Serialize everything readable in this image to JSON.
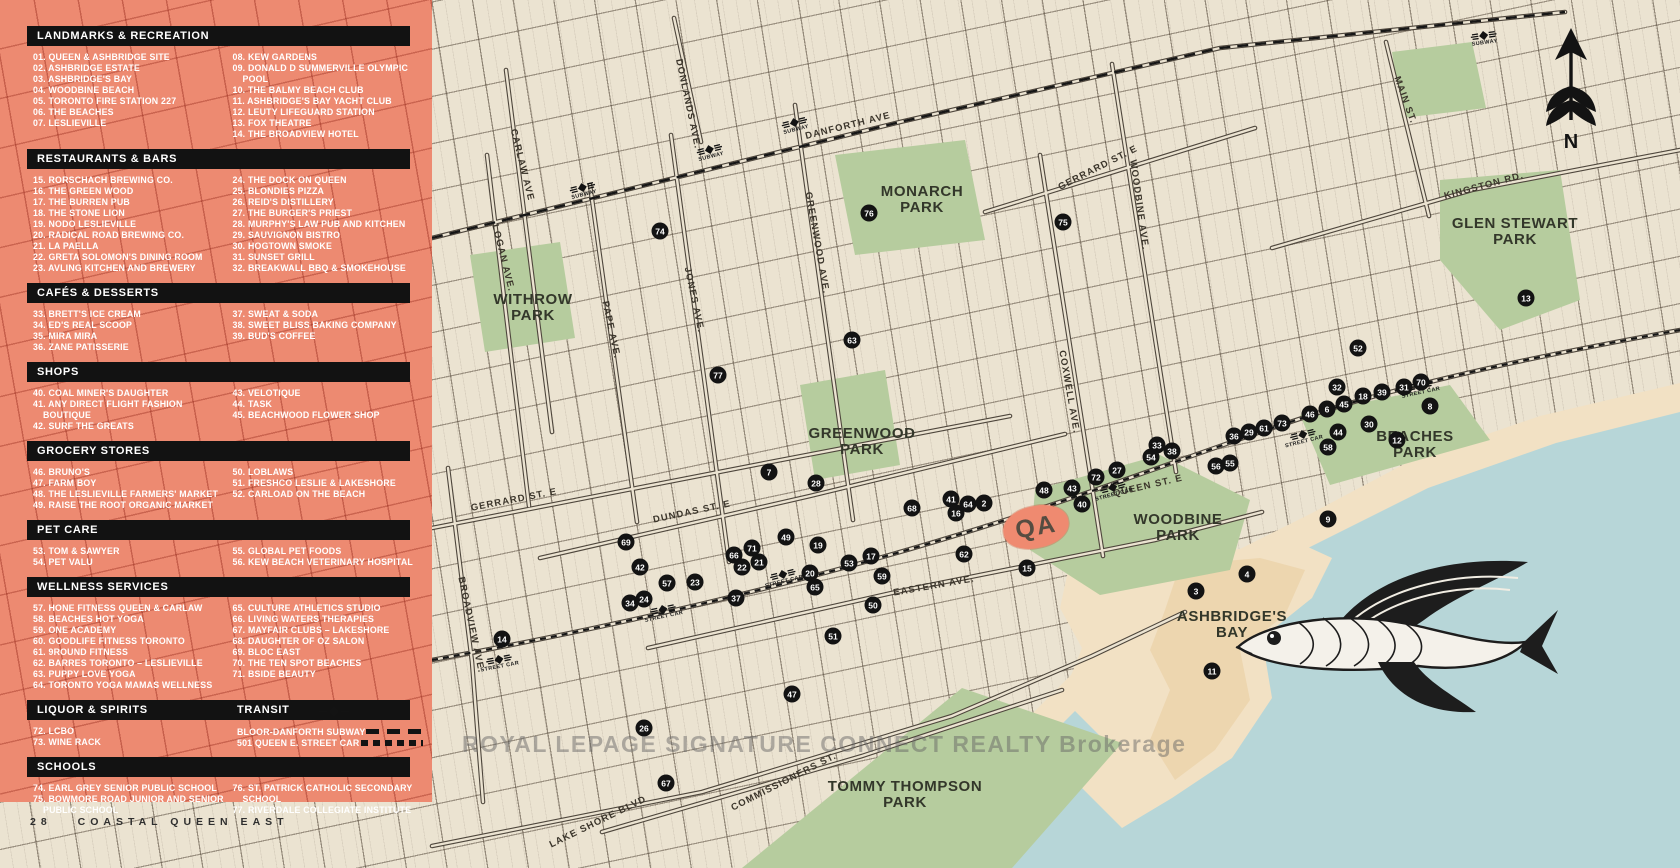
{
  "page": {
    "footer_page_number": "28",
    "footer_title": "COASTAL QUEEN EAST",
    "watermark": "ROYAL LEPAGE SIGNATURE CONNECT REALTY Brokerage"
  },
  "colors": {
    "salmon": "#ed8a71",
    "bar_black": "#121212",
    "map_cream": "#ebe3d1",
    "park_green": "#b6cc9e",
    "water_blue": "#b7d6d8",
    "sand": "#f2e1c4"
  },
  "compass": {
    "north_label": "N"
  },
  "site_logo": {
    "text": "QA"
  },
  "legend": {
    "sections": [
      {
        "title": "LANDMARKS & RECREATION",
        "columns": [
          [
            "01. QUEEN & ASHBRIDGE SITE",
            "02. ASHBRIDGE ESTATE",
            "03. ASHBRIDGE'S BAY",
            "04. WOODBINE BEACH",
            "05. TORONTO FIRE STATION 227",
            "06. THE BEACHES",
            "07. LESLIEVILLE"
          ],
          [
            "08. KEW GARDENS",
            "09. DONALD D SUMMERVILLE OLYMPIC POOL",
            "10. THE BALMY BEACH CLUB",
            "11. ASHBRIDGE'S BAY YACHT CLUB",
            "12. LEUTY LIFEGUARD STATION",
            "13. FOX THEATRE",
            "14. THE BROADVIEW HOTEL"
          ]
        ]
      },
      {
        "title": "RESTAURANTS & BARS",
        "columns": [
          [
            "15. RORSCHACH BREWING CO.",
            "16. THE GREEN WOOD",
            "17. THE BURREN PUB",
            "18. THE STONE LION",
            "19. NODO LESLIEVILLE",
            "20. RADICAL ROAD BREWING CO.",
            "21. LA PAELLA",
            "22. GRETA SOLOMON'S DINING ROOM",
            "23. AVLING KITCHEN AND BREWERY"
          ],
          [
            "24. THE DOCK ON QUEEN",
            "25. BLONDIES PIZZA",
            "26. REID'S DISTILLERY",
            "27. THE BURGER'S PRIEST",
            "28. MURPHY'S LAW PUB AND KITCHEN",
            "29. SAUVIGNON BISTRO",
            "30. HOGTOWN SMOKE",
            "31. SUNSET GRILL",
            "32. BREAKWALL BBQ & SMOKEHOUSE"
          ]
        ]
      },
      {
        "title": "CAFÉS & DESSERTS",
        "columns": [
          [
            "33. BRETT'S ICE CREAM",
            "34. ED'S REAL SCOOP",
            "35. MIRA MIRA",
            "36. ZANE PATISSERIE"
          ],
          [
            "37. SWEAT & SODA",
            "38. SWEET BLISS BAKING COMPANY",
            "39. BUD'S COFFEE"
          ]
        ]
      },
      {
        "title": "SHOPS",
        "columns": [
          [
            "40. COAL MINER'S DAUGHTER",
            "41. ANY DIRECT FLIGHT FASHION BOUTIQUE",
            "42. SURF THE GREATS"
          ],
          [
            "43. VELOTIQUE",
            "44. TASK",
            "45. BEACHWOOD FLOWER SHOP"
          ]
        ]
      },
      {
        "title": "GROCERY STORES",
        "columns": [
          [
            "46. BRUNO'S",
            "47. FARM BOY",
            "48. THE LESLIEVILLE FARMERS' MARKET",
            "49. RAISE THE ROOT ORGANIC MARKET"
          ],
          [
            "50. LOBLAWS",
            "51. FRESHCO LESLIE & LAKESHORE",
            "52. CARLOAD ON THE BEACH"
          ]
        ]
      },
      {
        "title": "PET CARE",
        "columns": [
          [
            "53. TOM & SAWYER",
            "54. PET VALU"
          ],
          [
            "55. GLOBAL PET FOODS",
            "56. KEW BEACH VETERINARY HOSPITAL"
          ]
        ]
      },
      {
        "title": "WELLNESS SERVICES",
        "columns": [
          [
            "57. HONE FITNESS QUEEN & CARLAW",
            "58. BEACHES HOT YOGA",
            "59. ONE ACADEMY",
            "60. GOODLIFE FITNESS TORONTO",
            "61. 9ROUND FITNESS",
            "62. BARRES TORONTO – LESLIEVILLE",
            "63. PUPPY LOVE YOGA",
            "64. TORONTO YOGA MAMAS WELLNESS"
          ],
          [
            "65. CULTURE ATHLETICS STUDIO",
            "66. LIVING WATERS THERAPIES",
            "67. MAYFAIR CLUBS – LAKESHORE",
            "68. DAUGHTER OF OZ SALON",
            "69. BLOC EAST",
            "70. THE TEN SPOT BEACHES",
            "71. BSIDE BEAUTY"
          ]
        ]
      },
      {
        "title": "LIQUOR & SPIRITS",
        "extra_title": "TRANSIT",
        "columns": [
          [
            "72. LCBO",
            "73. WINE RACK"
          ]
        ],
        "transit_lines": [
          {
            "name": "BLOOR-DANFORTH SUBWAY",
            "style": "dashes"
          },
          {
            "name": "501 QUEEN E. STREET CAR",
            "style": "dots"
          }
        ]
      },
      {
        "title": "SCHOOLS",
        "columns": [
          [
            "74. EARL GREY SENIOR PUBLIC SCHOOL",
            "75. BOWMORE ROAD JUNIOR AND SENIOR PUBLIC SCHOOL"
          ],
          [
            "76. ST. PATRICK CATHOLIC SECONDARY SCHOOL",
            "77. RIVERDALE COLLEGIATE INSTITUTE"
          ]
        ]
      }
    ]
  },
  "map": {
    "parks": [
      {
        "name": "WITHROW PARK",
        "x": 533,
        "y": 308,
        "w": 100
      },
      {
        "name": "MONARCH PARK",
        "x": 922,
        "y": 200,
        "w": 110
      },
      {
        "name": "GREENWOOD PARK",
        "x": 862,
        "y": 442,
        "w": 120
      },
      {
        "name": "WOODBINE PARK",
        "x": 1178,
        "y": 528,
        "w": 120
      },
      {
        "name": "GLEN STEWART PARK",
        "x": 1515,
        "y": 232,
        "w": 150
      },
      {
        "name": "BEACHES PARK",
        "x": 1415,
        "y": 445,
        "w": 110
      },
      {
        "name": "ASHBRIDGE'S BAY",
        "x": 1232,
        "y": 625,
        "w": 130
      },
      {
        "name": "TOMMY THOMPSON PARK",
        "x": 905,
        "y": 795,
        "w": 160
      }
    ],
    "streets": [
      {
        "name": "DANFORTH AVE",
        "x": 848,
        "y": 126,
        "rot": -14
      },
      {
        "name": "CARLAW AVE",
        "x": 522,
        "y": 165,
        "rot": 76
      },
      {
        "name": "LOGAN AVE.",
        "x": 503,
        "y": 258,
        "rot": 76
      },
      {
        "name": "PAPE AVE.",
        "x": 611,
        "y": 330,
        "rot": 78
      },
      {
        "name": "JONES AVE.",
        "x": 694,
        "y": 300,
        "rot": 78
      },
      {
        "name": "DONLANDS AVE.",
        "x": 688,
        "y": 104,
        "rot": 78
      },
      {
        "name": "GREENWOOD AVE.",
        "x": 817,
        "y": 243,
        "rot": 80
      },
      {
        "name": "COXWELL AVE.",
        "x": 1069,
        "y": 392,
        "rot": 80
      },
      {
        "name": "WOODBINE AVE.",
        "x": 1139,
        "y": 205,
        "rot": 82
      },
      {
        "name": "MAIN ST.",
        "x": 1405,
        "y": 100,
        "rot": 70
      },
      {
        "name": "KINGSTON RD.",
        "x": 1484,
        "y": 186,
        "rot": -15
      },
      {
        "name": "GERRARD ST. E",
        "x": 514,
        "y": 500,
        "rot": -11
      },
      {
        "name": "GERRARD ST. E",
        "x": 1098,
        "y": 168,
        "rot": -27
      },
      {
        "name": "DUNDAS ST. E",
        "x": 692,
        "y": 512,
        "rot": -12
      },
      {
        "name": "QUEEN ST. E",
        "x": 1148,
        "y": 486,
        "rot": -13
      },
      {
        "name": "EASTERN AVE.",
        "x": 934,
        "y": 586,
        "rot": -10
      },
      {
        "name": "BROADVIEW AVE.",
        "x": 471,
        "y": 625,
        "rot": 78
      },
      {
        "name": "LAKE SHORE BLVD",
        "x": 598,
        "y": 822,
        "rot": -26
      },
      {
        "name": "COMMISSIONERS ST.",
        "x": 784,
        "y": 782,
        "rot": -27
      }
    ],
    "subway_label": "SUBWAY",
    "streetcar_label": "STREET CAR",
    "subway_stations": [
      {
        "x": 583,
        "y": 190,
        "rot": -14
      },
      {
        "x": 710,
        "y": 152,
        "rot": -14
      },
      {
        "x": 795,
        "y": 125,
        "rot": -14
      },
      {
        "x": 1484,
        "y": 38,
        "rot": -8
      }
    ],
    "streetcar_stops": [
      {
        "x": 499,
        "y": 662,
        "rot": -11
      },
      {
        "x": 663,
        "y": 612,
        "rot": -12
      },
      {
        "x": 783,
        "y": 577,
        "rot": -14
      },
      {
        "x": 1113,
        "y": 490,
        "rot": -15
      },
      {
        "x": 1303,
        "y": 437,
        "rot": -14
      },
      {
        "x": 1420,
        "y": 388,
        "rot": -12
      }
    ],
    "markers": [
      [
        74,
        660,
        231
      ],
      [
        76,
        869,
        213
      ],
      [
        75,
        1063,
        222
      ],
      [
        13,
        1526,
        298
      ],
      [
        52,
        1358,
        348
      ],
      [
        77,
        718,
        375
      ],
      [
        63,
        852,
        340
      ],
      [
        7,
        769,
        472
      ],
      [
        28,
        816,
        483
      ],
      [
        69,
        626,
        542
      ],
      [
        42,
        640,
        567
      ],
      [
        66,
        734,
        555
      ],
      [
        71,
        752,
        548
      ],
      [
        22,
        742,
        567
      ],
      [
        21,
        759,
        562
      ],
      [
        49,
        786,
        537
      ],
      [
        19,
        818,
        545
      ],
      [
        57,
        667,
        583
      ],
      [
        23,
        695,
        582
      ],
      [
        34,
        630,
        603
      ],
      [
        24,
        644,
        599
      ],
      [
        37,
        736,
        598
      ],
      [
        14,
        502,
        639
      ],
      [
        20,
        810,
        573
      ],
      [
        65,
        815,
        587
      ],
      [
        17,
        871,
        556
      ],
      [
        53,
        849,
        563
      ],
      [
        59,
        882,
        576
      ],
      [
        50,
        873,
        605
      ],
      [
        51,
        833,
        636
      ],
      [
        47,
        792,
        694
      ],
      [
        26,
        644,
        728
      ],
      [
        67,
        666,
        783
      ],
      [
        41,
        951,
        499
      ],
      [
        64,
        968,
        504
      ],
      [
        2,
        984,
        503
      ],
      [
        16,
        956,
        513
      ],
      [
        62,
        964,
        554
      ],
      [
        15,
        1027,
        568
      ],
      [
        68,
        912,
        508
      ],
      [
        40,
        1082,
        504
      ],
      [
        48,
        1044,
        490
      ],
      [
        43,
        1072,
        488
      ],
      [
        72,
        1096,
        477
      ],
      [
        27,
        1117,
        470
      ],
      [
        33,
        1157,
        445
      ],
      [
        38,
        1172,
        451
      ],
      [
        54,
        1151,
        457
      ],
      [
        56,
        1216,
        466
      ],
      [
        55,
        1230,
        463
      ],
      [
        36,
        1234,
        436
      ],
      [
        29,
        1249,
        432
      ],
      [
        61,
        1264,
        428
      ],
      [
        73,
        1282,
        423
      ],
      [
        46,
        1310,
        414
      ],
      [
        6,
        1327,
        409
      ],
      [
        45,
        1344,
        404
      ],
      [
        18,
        1363,
        396
      ],
      [
        39,
        1382,
        392
      ],
      [
        31,
        1404,
        387
      ],
      [
        70,
        1421,
        382
      ],
      [
        32,
        1337,
        387
      ],
      [
        8,
        1430,
        406
      ],
      [
        30,
        1369,
        424
      ],
      [
        44,
        1338,
        432
      ],
      [
        58,
        1328,
        447
      ],
      [
        12,
        1397,
        440
      ],
      [
        9,
        1328,
        519
      ],
      [
        3,
        1196,
        591
      ],
      [
        4,
        1247,
        574
      ],
      [
        11,
        1212,
        671
      ]
    ]
  }
}
